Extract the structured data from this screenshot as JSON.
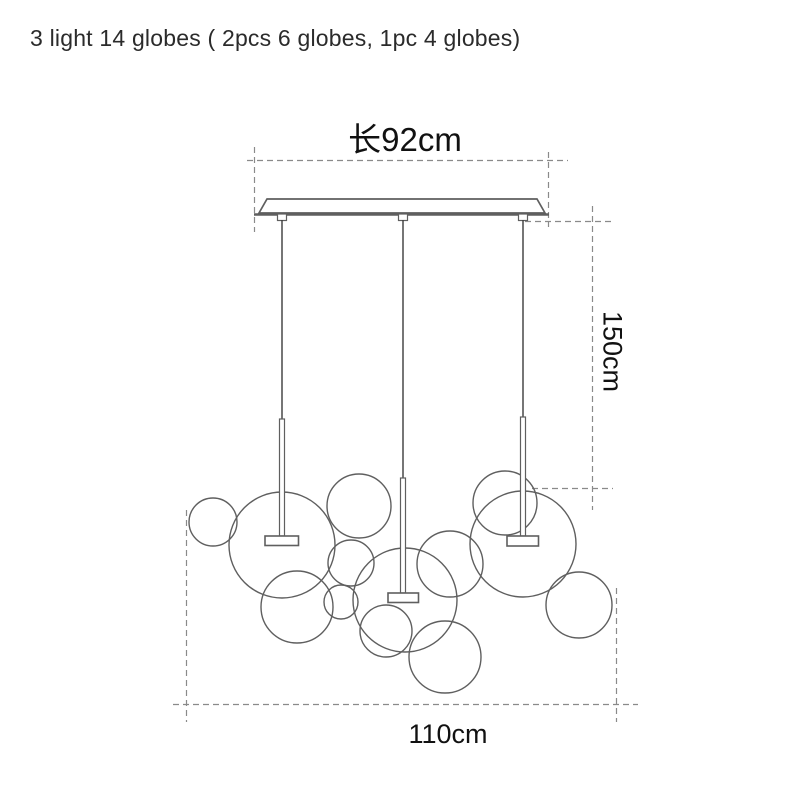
{
  "labels": {
    "title": "3 light 14 globes ( 2pcs 6 globes, 1pc 4 globes)",
    "dim_length": "长92cm",
    "dim_height": "150cm",
    "dim_width": "110cm"
  },
  "colors": {
    "line": "#5f5f5f",
    "dash": "#8a8a8a",
    "wire": "#3c3c3c",
    "text": "#111111",
    "background": "#ffffff"
  },
  "diagram": {
    "dashed_lines": [
      {
        "x1": 247,
        "y1": 160.5,
        "x2": 568,
        "y2": 160.5,
        "name": "dim-line-length"
      },
      {
        "x1": 254.5,
        "y1": 147,
        "x2": 254.5,
        "y2": 232,
        "name": "dim-tick-length-left"
      },
      {
        "x1": 548.5,
        "y1": 152,
        "x2": 548.5,
        "y2": 227,
        "name": "dim-tick-length-right"
      },
      {
        "x1": 525,
        "y1": 221.5,
        "x2": 612,
        "y2": 221.5,
        "name": "dim-ref-height-top"
      },
      {
        "x1": 592.5,
        "y1": 206,
        "x2": 592.5,
        "y2": 510,
        "name": "dim-line-height"
      },
      {
        "x1": 532,
        "y1": 488.5,
        "x2": 613,
        "y2": 488.5,
        "name": "dim-ref-height-bottom"
      },
      {
        "x1": 173,
        "y1": 704.5,
        "x2": 638,
        "y2": 704.5,
        "name": "dim-line-width"
      },
      {
        "x1": 186.5,
        "y1": 510,
        "x2": 186.5,
        "y2": 722,
        "name": "dim-tick-width-left"
      },
      {
        "x1": 616.5,
        "y1": 588,
        "x2": 616.5,
        "y2": 722,
        "name": "dim-tick-width-right"
      }
    ],
    "canopy": {
      "body": "267,199 537,199 545,213 259,213",
      "baseline": {
        "x1": 254,
        "y1": 214.5,
        "x2": 549,
        "y2": 214.5
      },
      "connector_xs": [
        282,
        403,
        523
      ],
      "connector_y": 214,
      "connector_w": 9,
      "connector_h": 6.5
    },
    "pendants": [
      {
        "wire_x": 282,
        "wire_y1": 220,
        "wire_y2": 419,
        "rod_x": 279.5,
        "rod_y": 419,
        "rod_w": 5,
        "rod_h": 117,
        "plate_x": 265,
        "plate_y": 536,
        "plate_w": 33.5,
        "plate_h": 9.5
      },
      {
        "wire_x": 403,
        "wire_y1": 220,
        "wire_y2": 478,
        "rod_x": 400.5,
        "rod_y": 478,
        "rod_w": 5,
        "rod_h": 115,
        "plate_x": 388,
        "plate_y": 593,
        "plate_w": 30.5,
        "plate_h": 9.5
      },
      {
        "wire_x": 523,
        "wire_y1": 220,
        "wire_y2": 417,
        "rod_x": 520.5,
        "rod_y": 417,
        "rod_w": 5,
        "rod_h": 119,
        "plate_x": 507,
        "plate_y": 536,
        "plate_w": 31.5,
        "plate_h": 10
      }
    ],
    "globes": [
      [
        213,
        522,
        24
      ],
      [
        282,
        545,
        53
      ],
      [
        359,
        506,
        32
      ],
      [
        351,
        563,
        23
      ],
      [
        297,
        607,
        36
      ],
      [
        341,
        602,
        17
      ],
      [
        405,
        600,
        52
      ],
      [
        450,
        564,
        33
      ],
      [
        386,
        631,
        26
      ],
      [
        445,
        657,
        36
      ],
      [
        505,
        503,
        32
      ],
      [
        523,
        544,
        53
      ],
      [
        579,
        605,
        33
      ]
    ]
  }
}
